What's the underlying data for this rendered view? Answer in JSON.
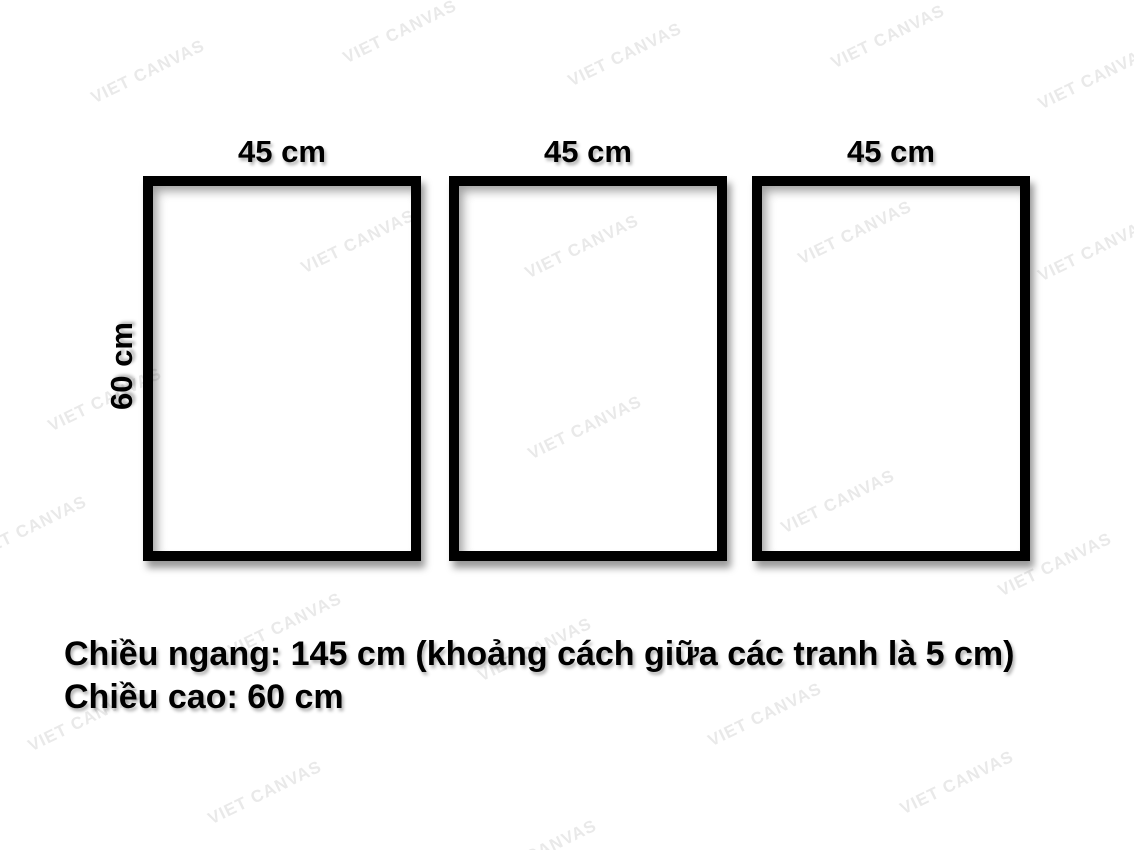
{
  "watermark": {
    "text": "VIET CANVAS",
    "color": "#e9e9e9"
  },
  "diagram": {
    "frames": [
      {
        "width_label": "45 cm"
      },
      {
        "width_label": "45 cm"
      },
      {
        "width_label": "45 cm"
      }
    ],
    "height_label": "60 cm"
  },
  "description": {
    "line1": "Chiều ngang: 145 cm (khoảng cách giữa các tranh là 5 cm)",
    "line2": "Chiều cao: 60 cm"
  },
  "colors": {
    "frame_border": "#000000",
    "canvas_background": "#ffffff",
    "text": "#000000",
    "watermark": "#e9e9e9"
  }
}
